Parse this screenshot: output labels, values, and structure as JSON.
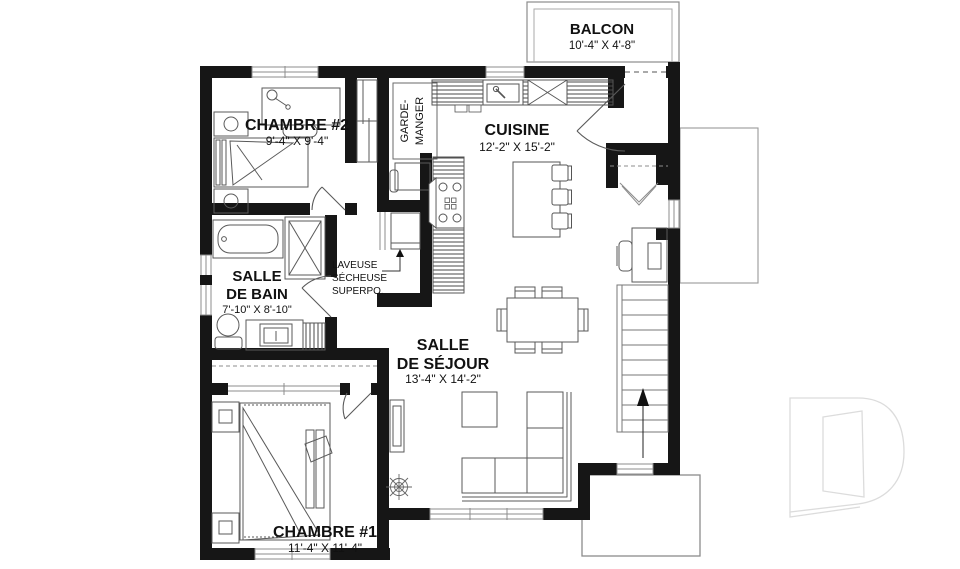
{
  "plan": {
    "balcony": {
      "name": "BALCON",
      "dims": "10'-4\" X 4'-8\""
    },
    "bedroom2": {
      "name": "CHAMBRE #2",
      "dims": "9'-4\" X 9'-4\""
    },
    "kitchen": {
      "name": "CUISINE",
      "dims": "12'-2\" X 15'-2\""
    },
    "pantry": {
      "line1": "GARDE-",
      "line2": "MANGER"
    },
    "bathroom": {
      "line1": "SALLE",
      "line2": "DE BAIN",
      "dims": "7'-10\" X 8'-10\""
    },
    "laundry": {
      "line1": "LAVEUSE",
      "line2": "SÉCHEUSE",
      "line3": "SUPERPO."
    },
    "living": {
      "line1": "SALLE",
      "line2": "DE SÉJOUR",
      "dims": "13'-4\" X 14'-2\""
    },
    "bedroom1": {
      "name": "CHAMBRE #1",
      "dims": "11'-4\" X 11'-4\""
    },
    "stairs": {
      "direction": "up"
    },
    "watermark": {
      "icon": "letter-d-outline"
    },
    "colors": {
      "wall": "#161616",
      "furniture": "#5a5a5a",
      "window": "#8c8c8c",
      "watermark": "#dcdcdc"
    }
  }
}
